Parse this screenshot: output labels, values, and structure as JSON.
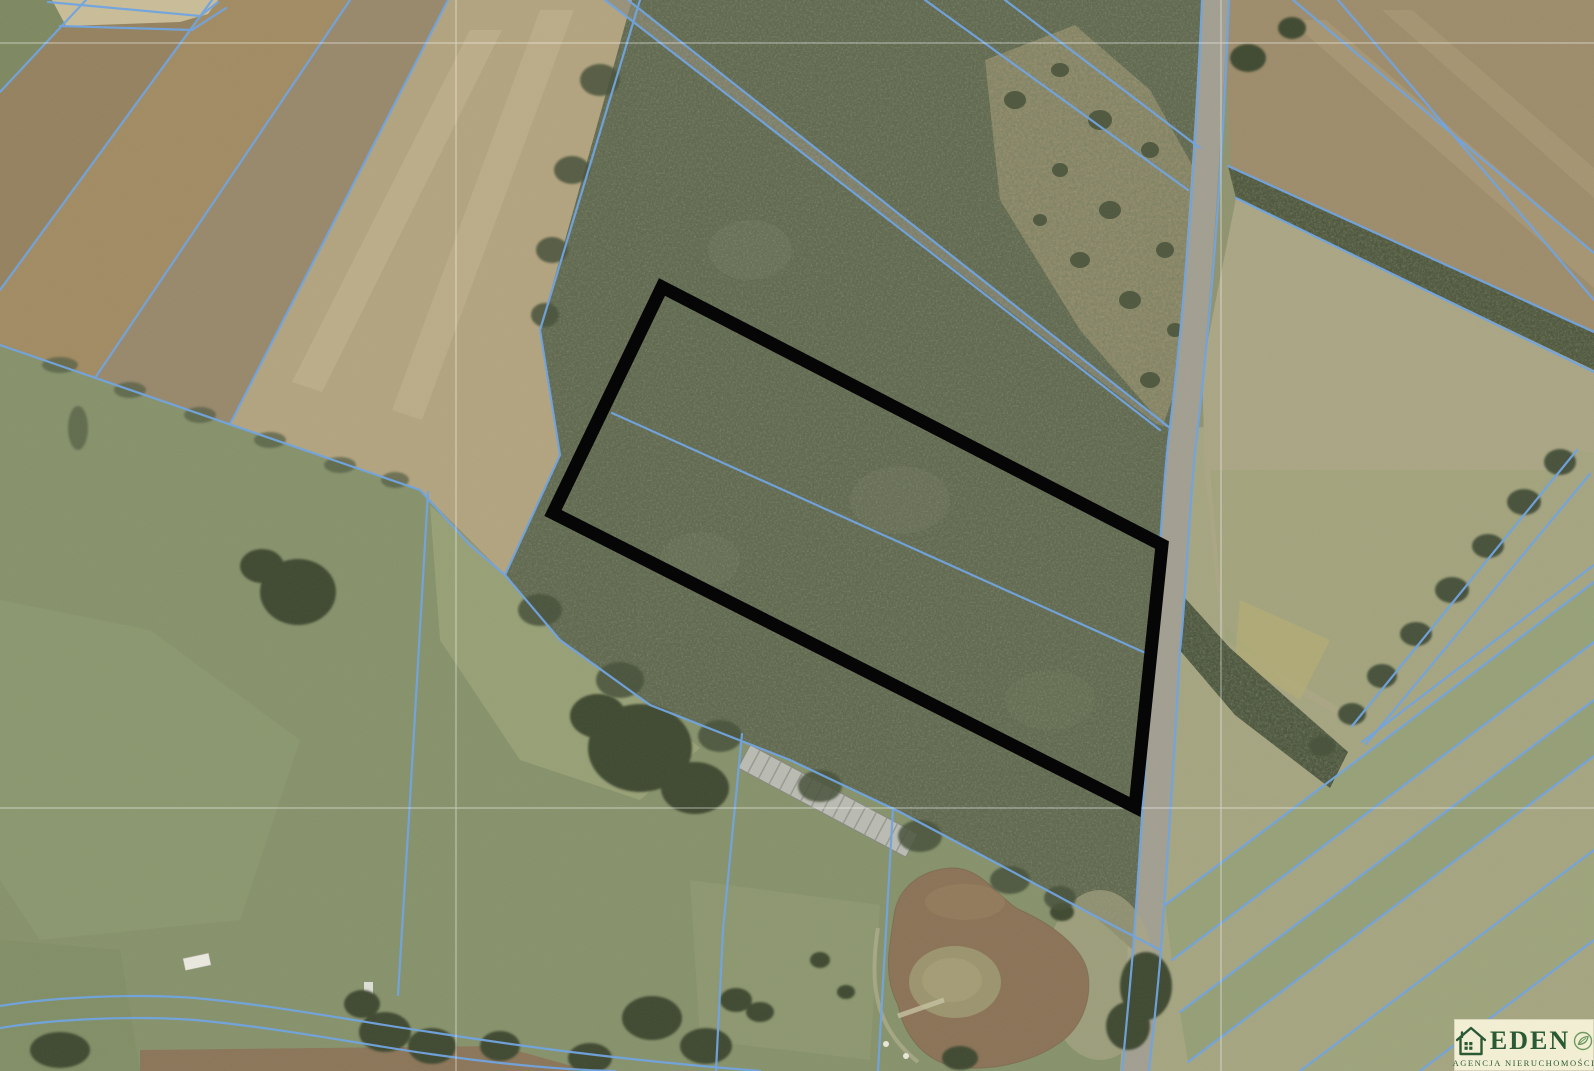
{
  "page": {
    "title": "Satellite cadastral map with highlighted forest parcel"
  },
  "map": {
    "kind": "aerial-orthophoto-with-cadastral-overlay",
    "parcel_outline_points": "662,287 1162,545 1135,807 553,513",
    "colors": {
      "cadastral_line": "#6ea3e2",
      "parcel_outline": "#060606",
      "forest": "#5d654c",
      "meadow": "#85916a",
      "field_brown": "#a18a61",
      "field_pale": "#b2a37e",
      "road": "#a19e90",
      "pond_water": "#8a7155",
      "graticule": "#ffffff"
    }
  },
  "logo": {
    "brand": "EDEN",
    "tagline": "AGENCJA NIERUCHOMOŚCI",
    "colors": {
      "background": "#f2eed4",
      "text": "#2a5a34",
      "leaf": "#6f9b63"
    }
  }
}
